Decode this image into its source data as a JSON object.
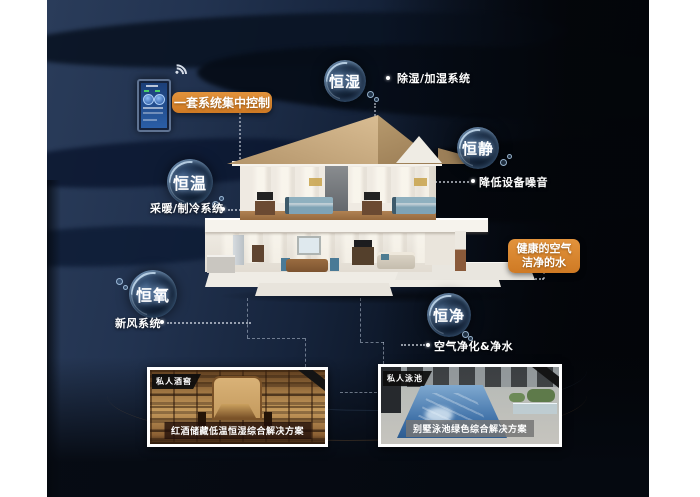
{
  "colors": {
    "accent_orange": "#d9832e",
    "background_navy": "#223350",
    "background_dark": "#04070d",
    "bubble_glow_blue": "#9fc6e8"
  },
  "control_panel": {
    "label": "一套系统集中控制",
    "device": "wall-mounted smart control panel",
    "wifi_icon": "wifi-icon"
  },
  "bubbles": [
    {
      "id": "heng-shi",
      "label": "恒湿",
      "desc": "除湿/加湿系统"
    },
    {
      "id": "heng-jing",
      "label": "恒静",
      "desc": "降低设备噪音"
    },
    {
      "id": "heng-wen",
      "label": "恒温",
      "desc": "采暖/制冷系统"
    },
    {
      "id": "heng-yang",
      "label": "恒氧",
      "desc": "新风系统"
    },
    {
      "id": "heng-jin",
      "label": "恒净",
      "desc": "空气净化&净水"
    }
  ],
  "highlight": {
    "line1": "健康的空气",
    "line2": "洁净的水"
  },
  "cards": [
    {
      "badge": "私人酒窖",
      "caption": "红酒储藏低温恒湿综合解决方案",
      "type": "wine-cellar-photo"
    },
    {
      "badge": "私人泳池",
      "caption": "别墅泳池绿色综合解决方案",
      "type": "pool-photo"
    }
  ]
}
